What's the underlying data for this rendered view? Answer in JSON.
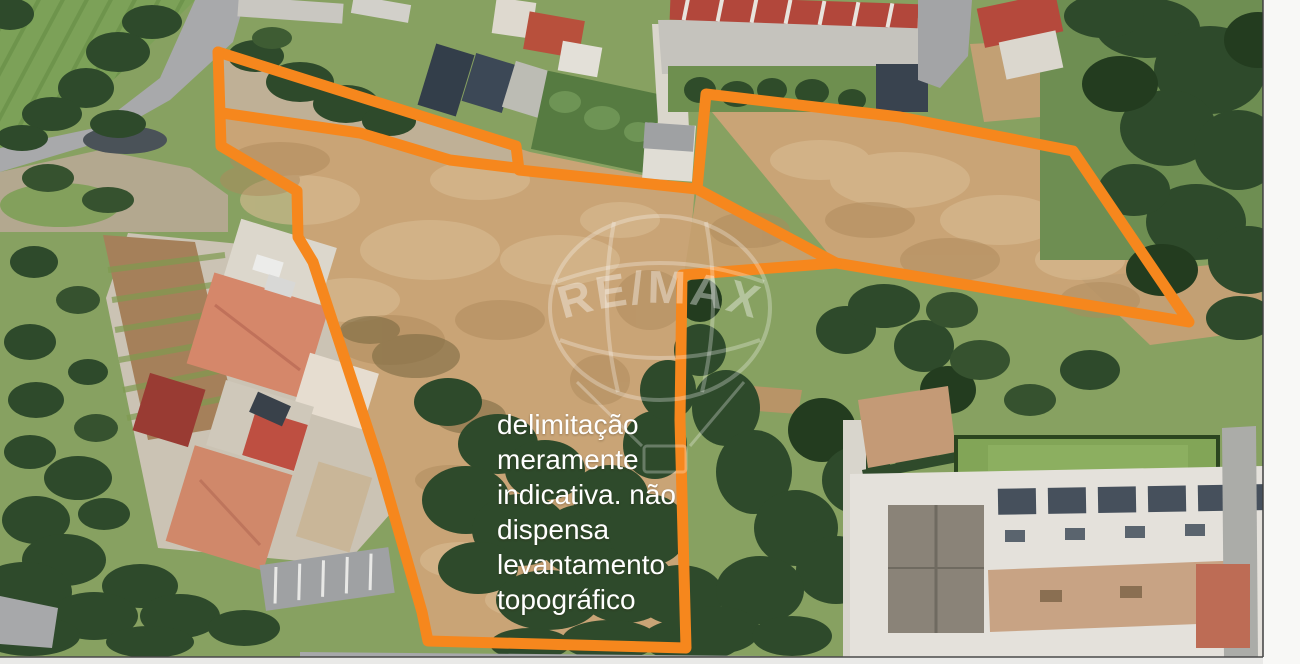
{
  "photo": {
    "kind_label": "aerial-satellite-photo",
    "palette": {
      "boundary_orange": "#F6871D",
      "disclaimer_white": "#FFFFFF",
      "watermark_white": "rgba(255,255,255,0.34)",
      "dirt_tan": "#C9A476",
      "grass_green": "#87A161",
      "tree_dark_green": "#2E4A2B",
      "road_gray": "#A6A7A9",
      "roof_red": "#B5493C",
      "roof_salmon": "#D5876A",
      "roof_slate": "#3A4553",
      "building_white": "#E4E1DB",
      "edge_strip": "#F7F7F5"
    }
  },
  "disclaimer": {
    "lines": [
      "delimitação",
      "meramente",
      "indicativa. não",
      "dispensa",
      "levantamento",
      "topográfico"
    ]
  },
  "watermark": {
    "brand": "RE/MAX"
  },
  "overlay": {
    "color": "#F6871D",
    "stroke_width": 11,
    "polylines": [
      {
        "name": "north-boundary-and-right-lobe",
        "closed": false,
        "points": [
          [
            218,
            52
          ],
          [
            516,
            146
          ],
          [
            519,
            170
          ],
          [
            697,
            189
          ],
          [
            706,
            94
          ],
          [
            900,
            117
          ],
          [
            1073,
            151
          ],
          [
            1189,
            322
          ],
          [
            836,
            263
          ],
          [
            697,
            189
          ]
        ]
      },
      {
        "name": "west-south-boundary",
        "closed": false,
        "points": [
          [
            836,
            263
          ],
          [
            682,
            275
          ],
          [
            680,
            420
          ],
          [
            686,
            648
          ],
          [
            428,
            641
          ],
          [
            422,
            612
          ],
          [
            380,
            466
          ],
          [
            313,
            262
          ],
          [
            298,
            237
          ],
          [
            297,
            191
          ],
          [
            287,
            185
          ],
          [
            221,
            146
          ],
          [
            218,
            52
          ]
        ]
      },
      {
        "name": "inner-road-line",
        "closed": false,
        "points": [
          [
            222,
            113
          ],
          [
            360,
            133
          ],
          [
            450,
            160
          ],
          [
            516,
            168
          ]
        ]
      }
    ]
  }
}
